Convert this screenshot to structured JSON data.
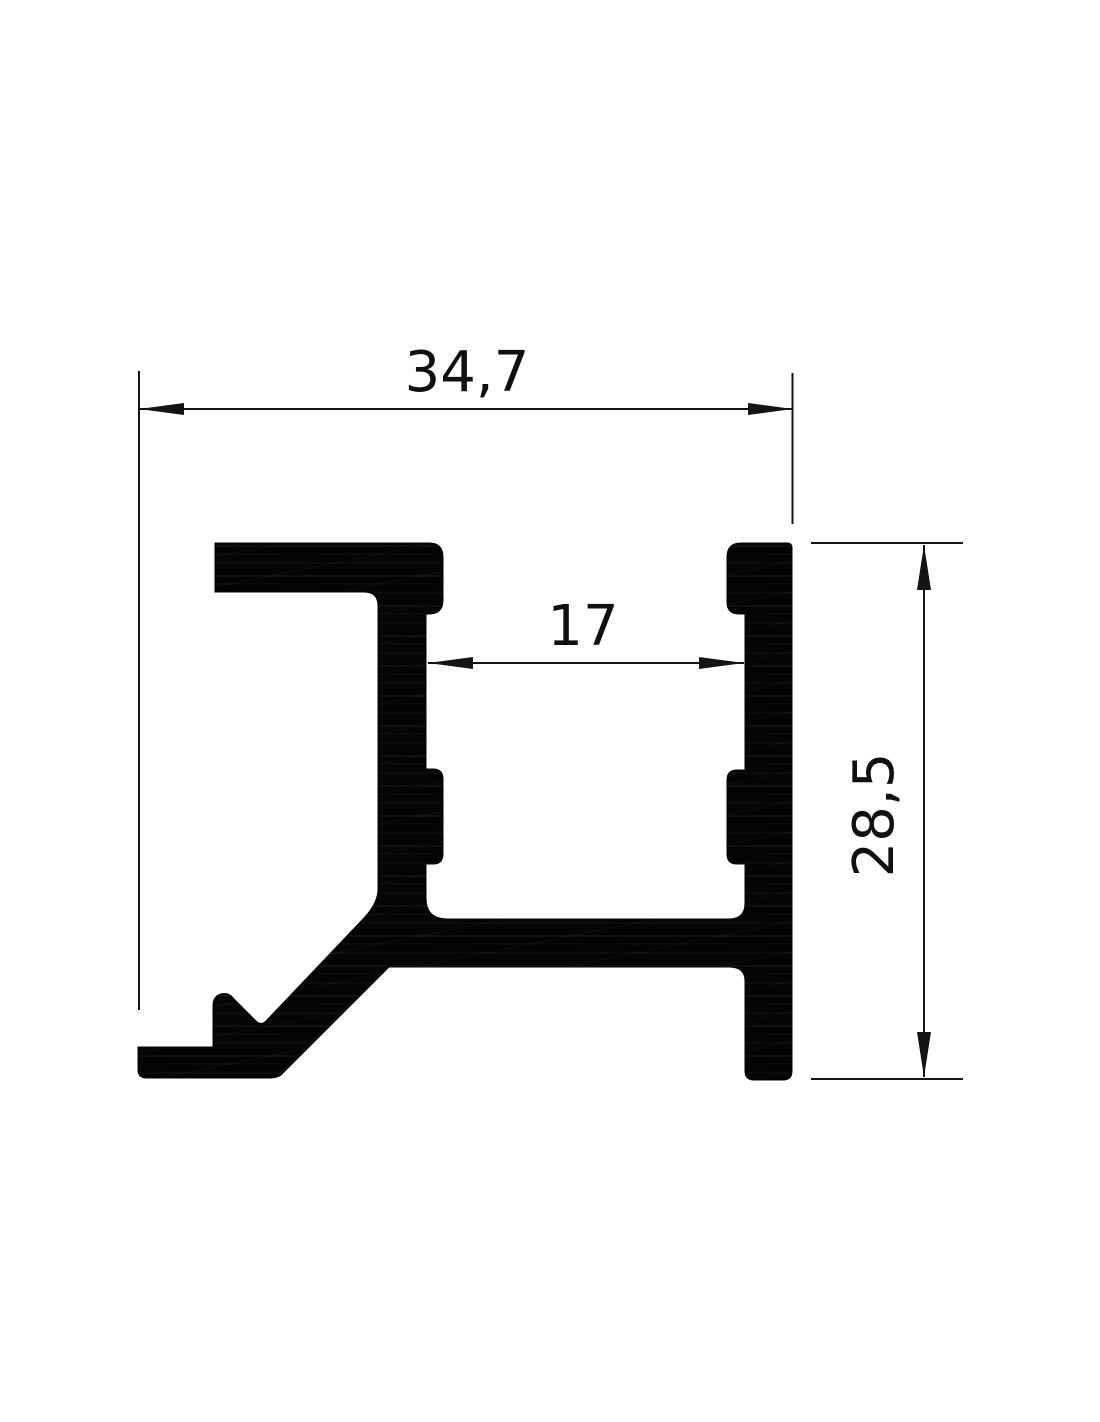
{
  "drawing": {
    "title": "aluminium-profile-cross-section",
    "dimensions": {
      "overall_width_mm": "34,7",
      "inner_gap_mm": "17",
      "overall_height_mm": "28,5"
    },
    "colors": {
      "background": "#ffffff",
      "profile_fill": "#040404",
      "dimension_line": "#141414",
      "text": "#101010"
    },
    "text_size_px": 56
  }
}
